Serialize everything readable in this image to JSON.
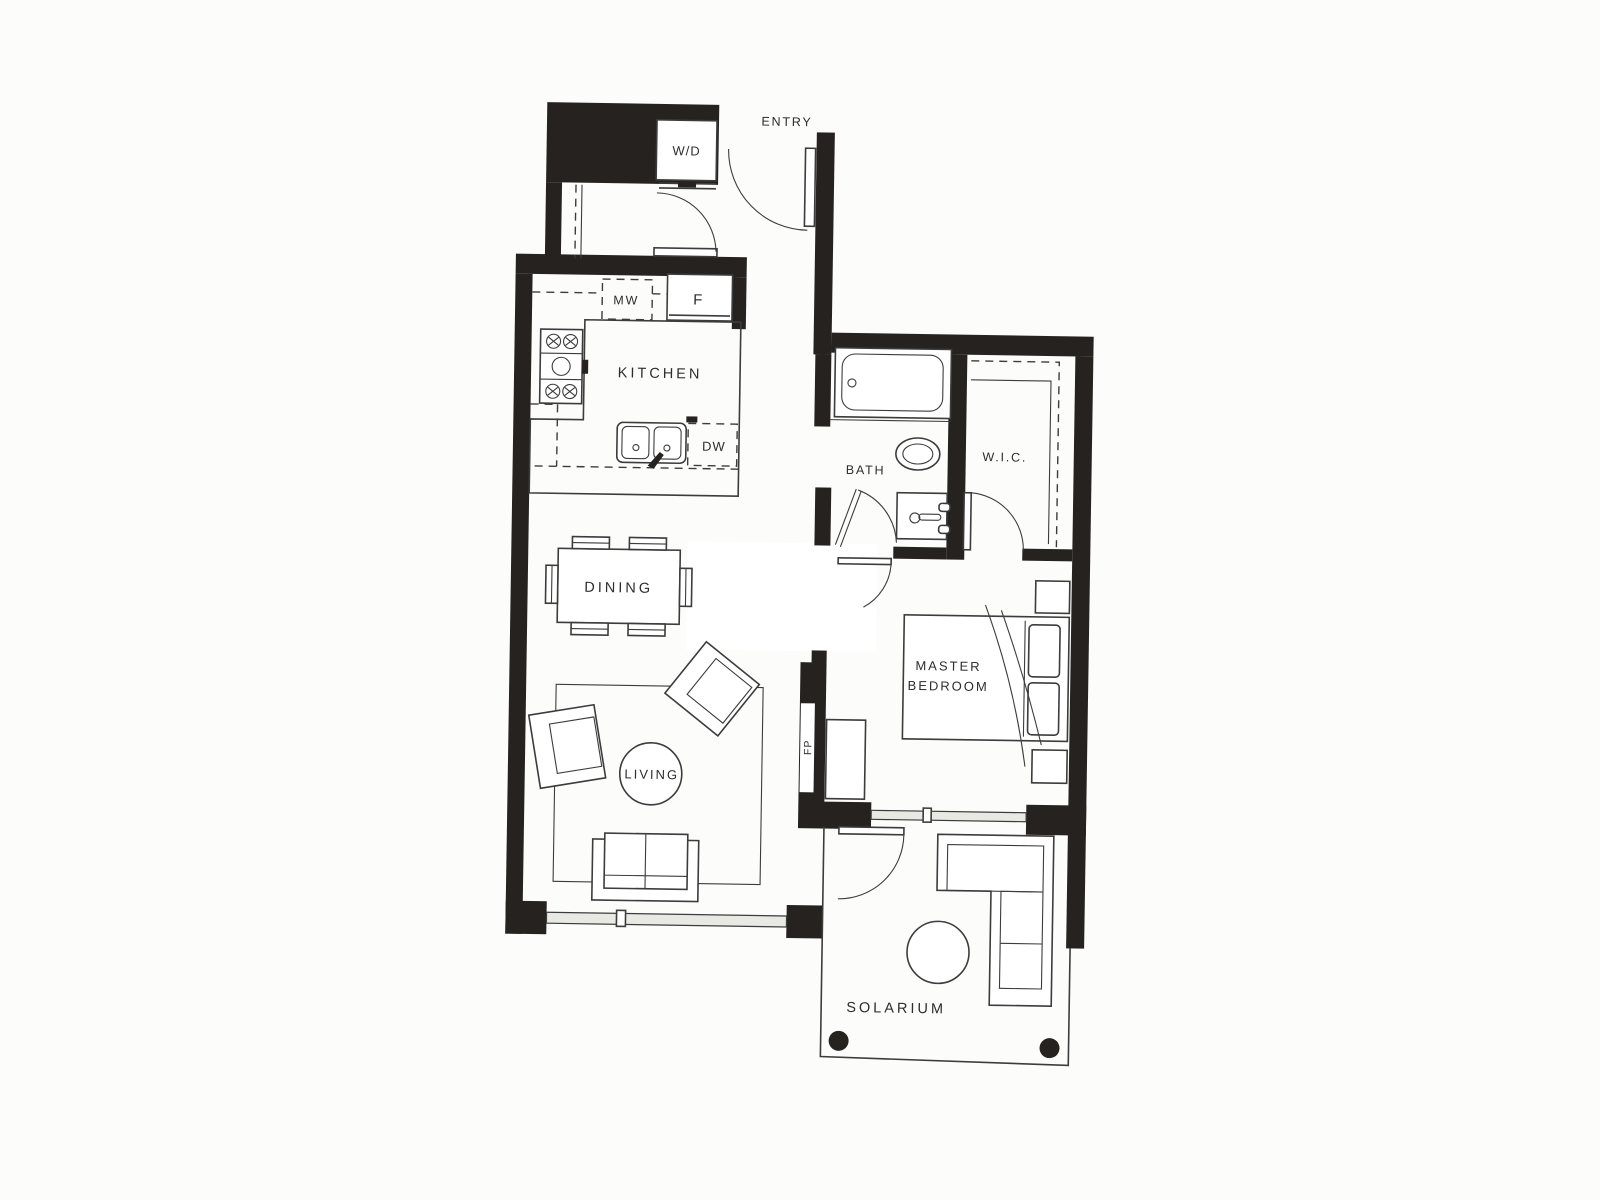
{
  "document": {
    "kind": "apartment-floor-plan"
  },
  "labels": {
    "entry": "ENTRY",
    "washer_dryer": "W/D",
    "microwave": "MW",
    "fridge": "F",
    "kitchen": "KITCHEN",
    "dishwasher": "DW",
    "bath": "BATH",
    "wic": "W.I.C.",
    "dining": "DINING",
    "master_line1": "MASTER",
    "master_line2": "BEDROOM",
    "living": "LIVING",
    "fireplace": "FP",
    "solarium": "SOLARIUM"
  },
  "colors": {
    "paper": "#fcfcfa",
    "wall": "#262220",
    "line": "#3c3c3c",
    "text": "#2d2d2d",
    "window_fill": "#e7e9e2"
  }
}
